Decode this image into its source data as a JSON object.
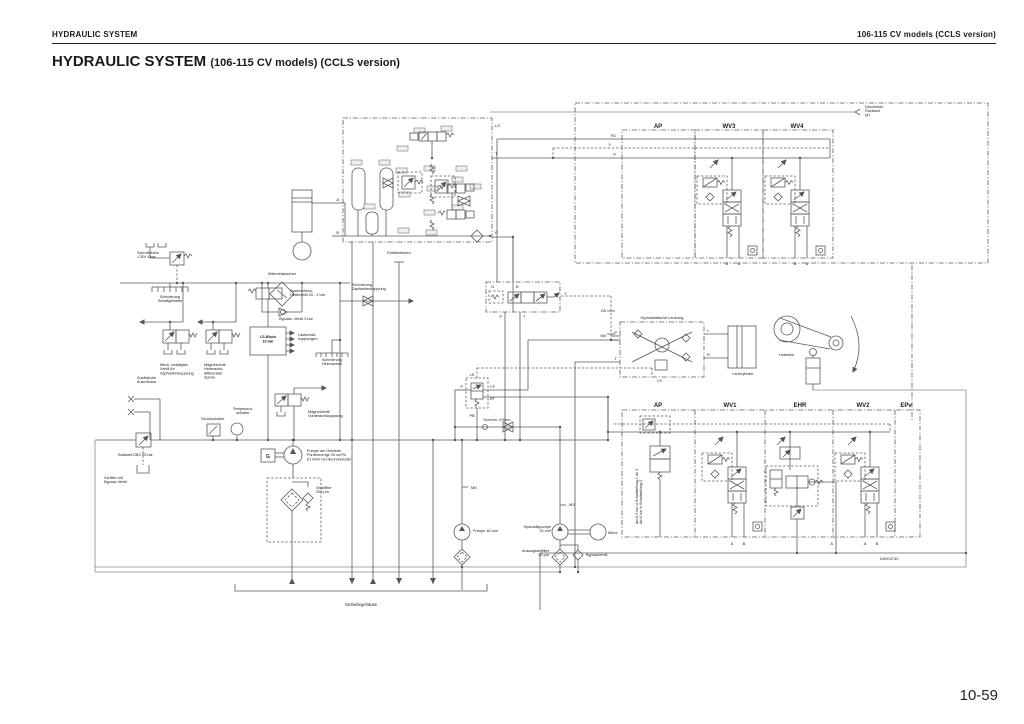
{
  "page": {
    "running_head_left": "HYDRAULIC SYSTEM",
    "running_head_right": "106-115 CV models (CCLS version)",
    "title": "HYDRAULIC SYSTEM",
    "title_suffix": "(106-115 CV models) (CCLS version)",
    "page_number": "10-59"
  },
  "diagram": {
    "labels": [
      {
        "n": "drucklose-ruecklauf",
        "t": [
          "Druckloser",
          "Rücklauf",
          "M7"
        ],
        "x": 865,
        "y": 108,
        "fs": 3.8,
        "lh": 4.2
      },
      {
        "n": "ap-top",
        "t": [
          "AP"
        ],
        "x": 658,
        "y": 128,
        "fs": 6,
        "b": 1,
        "a": "middle"
      },
      {
        "n": "wv3",
        "t": [
          "WV3"
        ],
        "x": 729,
        "y": 128,
        "fs": 6,
        "b": 1,
        "a": "middle"
      },
      {
        "n": "wv4",
        "t": [
          "WV4"
        ],
        "x": 797,
        "y": 128,
        "fs": 6,
        "b": 1,
        "a": "middle"
      },
      {
        "n": "r1-port",
        "t": [
          "R1"
        ],
        "x": 616,
        "y": 137,
        "fs": 4,
        "a": "end"
      },
      {
        "n": "y-port",
        "t": [
          "Y"
        ],
        "x": 611,
        "y": 146,
        "fs": 4,
        "a": "end"
      },
      {
        "n": "p-port-top",
        "t": [
          "P"
        ],
        "x": 616,
        "y": 156,
        "fs": 4,
        "a": "end"
      },
      {
        "n": "a-wv3",
        "t": [
          "A"
        ],
        "x": 727,
        "y": 265,
        "fs": 4,
        "a": "middle"
      },
      {
        "n": "b-wv3",
        "t": [
          "B"
        ],
        "x": 739,
        "y": 265,
        "fs": 4,
        "a": "middle"
      },
      {
        "n": "a-wv4",
        "t": [
          "A"
        ],
        "x": 795,
        "y": 265,
        "fs": 4,
        "a": "middle"
      },
      {
        "n": "b-wv4",
        "t": [
          "B"
        ],
        "x": 807,
        "y": 265,
        "fs": 4,
        "a": "middle"
      },
      {
        "n": "ls-valveblock",
        "t": [
          "LS"
        ],
        "x": 495,
        "y": 127,
        "fs": 4
      },
      {
        "n": "t-valveblock",
        "t": [
          "T"
        ],
        "x": 495,
        "y": 155,
        "fs": 4
      },
      {
        "n": "p-valveblock",
        "t": [
          "P"
        ],
        "x": 495,
        "y": 234,
        "fs": 4
      },
      {
        "n": "a-valveblock",
        "t": [
          "A"
        ],
        "x": 339,
        "y": 201,
        "fs": 4,
        "a": "end"
      },
      {
        "n": "b-valveblock",
        "t": [
          "B"
        ],
        "x": 339,
        "y": 234,
        "fs": 4,
        "a": "end"
      },
      {
        "n": "schmierkreis-cbv",
        "t": [
          "Schmierkreis",
          "-CBV 4 bar"
        ],
        "x": 137,
        "y": 254,
        "fs": 3.8,
        "lh": 4.2
      },
      {
        "n": "waermetauscher",
        "t": [
          "Wärmetauscher"
        ],
        "x": 282,
        "y": 275,
        "fs": 4,
        "a": "middle"
      },
      {
        "n": "schmierung-schaltgetriebe",
        "t": [
          "Schmierung",
          "Schaltgetriebe"
        ],
        "x": 170,
        "y": 298,
        "fs": 3.8,
        "a": "middle",
        "lh": 4.2
      },
      {
        "n": "bypass-ventil-3bar",
        "t": [
          "Bypass- Ventil 3 bar"
        ],
        "x": 296,
        "y": 320,
        "fs": 3.8,
        "a": "middle"
      },
      {
        "n": "systemdruck-halteventil",
        "t": [
          "Systemdruck-",
          "Halteventil 20 - 2 bar"
        ],
        "x": 290,
        "y": 292,
        "fs": 3.8,
        "lh": 4.2
      },
      {
        "n": "ls-block-text",
        "t": [
          "LS-Block",
          "10 bar"
        ],
        "x": 268,
        "y": 338,
        "fs": 3.8,
        "b": 1,
        "a": "middle",
        "lh": 4.4
      },
      {
        "n": "lastschalt-kupplungen",
        "t": [
          "Lastschalt-",
          "kupplungen"
        ],
        "x": 298,
        "y": 336,
        "fs": 3.8,
        "lh": 4.2
      },
      {
        "n": "mech-ventil-zapfwelle",
        "t": [
          "Mech. betätigtes",
          "Ventil für",
          "Zapfwellenkupplung"
        ],
        "x": 160,
        "y": 366,
        "fs": 3.8,
        "lh": 4.2
      },
      {
        "n": "magnetventil-hinterachs",
        "t": [
          "Magnetventil",
          "Hinterachs-",
          "differential-",
          "Sperre"
        ],
        "x": 204,
        "y": 366,
        "fs": 3.8,
        "lh": 4.2
      },
      {
        "n": "schmierung-hinterachse",
        "t": [
          "Schmierung",
          "Hinterachse"
        ],
        "x": 332,
        "y": 361,
        "fs": 3.8,
        "a": "middle",
        "lh": 4.2
      },
      {
        "n": "magnetventil-vorderachs",
        "t": [
          "Magnetventil",
          "Vorderachskupplung"
        ],
        "x": 308,
        "y": 413,
        "fs": 3.8,
        "lh": 4.2
      },
      {
        "n": "zusaetzliche-anschluesse",
        "t": [
          "Zusätzliche",
          "Anschlüsse"
        ],
        "x": 137,
        "y": 379,
        "fs": 3.8,
        "lh": 4.2
      },
      {
        "n": "druckschalter",
        "t": [
          "Druckschalter"
        ],
        "x": 213,
        "y": 420,
        "fs": 3.8,
        "a": "middle"
      },
      {
        "n": "temperatur-schalter",
        "t": [
          "Temperatur-",
          "schalter"
        ],
        "x": 243,
        "y": 410,
        "fs": 3.8,
        "a": "middle",
        "lh": 4.2
      },
      {
        "n": "kaltstart-dbv",
        "t": [
          "Kaltstart-DBV 25 bar"
        ],
        "x": 118,
        "y": 456,
        "fs": 3.8
      },
      {
        "n": "vorfilter",
        "t": [
          "Vorfilter mit",
          "Bypass-Ventil"
        ],
        "x": 104,
        "y": 479,
        "fs": 3.8,
        "lh": 4.2
      },
      {
        "n": "g-box-label",
        "t": [
          "G"
        ],
        "x": 268,
        "y": 458,
        "fs": 5,
        "b": 1,
        "a": "middle"
      },
      {
        "n": "pumpe-am-getriebe",
        "t": [
          "Pumpe am Getriebe",
          "Fördermenge 25 cm³/U",
          "61 l/min bei Nenndrehzahl"
        ],
        "x": 307,
        "y": 452,
        "fs": 3.8,
        "lh": 4.2
      },
      {
        "n": "grobfilter",
        "t": [
          "Grobfilter",
          "200 μm"
        ],
        "x": 316,
        "y": 489,
        "fs": 3.8,
        "lh": 4.2
      },
      {
        "n": "einfuellstutzen",
        "t": [
          "Einfüllstutzen"
        ],
        "x": 399,
        "y": 254,
        "fs": 4,
        "a": "middle"
      },
      {
        "n": "schmierung-zapfwellenkupplung",
        "t": [
          "Schmierung",
          "Zapfwellenkupplung"
        ],
        "x": 352,
        "y": 286,
        "fs": 3.8,
        "lh": 4.2
      },
      {
        "n": "durchmesser",
        "t": [
          "Durchm. 0,5mm"
        ],
        "x": 497,
        "y": 421,
        "fs": 3.8,
        "a": "middle"
      },
      {
        "n": "getriebegehaeuse",
        "t": [
          "Getriebegehäuse"
        ],
        "x": 361,
        "y": 606,
        "fs": 4.2,
        "a": "middle"
      },
      {
        "n": "pumpe-16ccm",
        "t": [
          "Pumpe 16 ccm"
        ],
        "x": 473,
        "y": 532,
        "fs": 3.8
      },
      {
        "n": "m6",
        "t": [
          "M6"
        ],
        "x": 471,
        "y": 489,
        "fs": 4
      },
      {
        "n": "m3",
        "t": [
          "M3"
        ],
        "x": 569,
        "y": 506,
        "fs": 4
      },
      {
        "n": "hydraulikpumpe",
        "t": [
          "Hydraulikpumpe",
          "32 cm³"
        ],
        "x": 551,
        "y": 528,
        "fs": 3.8,
        "a": "end",
        "lh": 4.2
      },
      {
        "n": "motor",
        "t": [
          "Motor"
        ],
        "x": 608,
        "y": 534,
        "fs": 3.8
      },
      {
        "n": "ansaugsiebfilter",
        "t": [
          "Ansaugsiebfilter",
          "25 μm"
        ],
        "x": 549,
        "y": 552,
        "fs": 3.8,
        "a": "end",
        "lh": 4.2
      },
      {
        "n": "bypassventil",
        "t": [
          "Bypassventil"
        ],
        "x": 586,
        "y": 556,
        "fs": 3.8
      },
      {
        "n": "d5",
        "t": [
          "D5"
        ],
        "x": 606,
        "y": 312,
        "fs": 4,
        "a": "end"
      },
      {
        "n": "m4",
        "t": [
          "M4"
        ],
        "x": 606,
        "y": 337,
        "fs": 4,
        "a": "end"
      },
      {
        "n": "hydrostatische-lenkung",
        "t": [
          "Hydrostatische Lenkung"
        ],
        "x": 662,
        "y": 319,
        "fs": 4,
        "a": "middle"
      },
      {
        "n": "p-lenkung",
        "t": [
          "P"
        ],
        "x": 617,
        "y": 334,
        "fs": 4,
        "a": "end"
      },
      {
        "n": "t-lenkung",
        "t": [
          "T"
        ],
        "x": 617,
        "y": 360,
        "fs": 4,
        "a": "end"
      },
      {
        "n": "l-lenkung",
        "t": [
          "L"
        ],
        "x": 707,
        "y": 332,
        "fs": 4
      },
      {
        "n": "r-lenkung",
        "t": [
          "R"
        ],
        "x": 707,
        "y": 356,
        "fs": 4
      },
      {
        "n": "ls-lenkung",
        "t": [
          "LS"
        ],
        "x": 657,
        "y": 382,
        "fs": 4
      },
      {
        "n": "lenkzylinder",
        "t": [
          "Lenkzylinder"
        ],
        "x": 743,
        "y": 375,
        "fs": 3.8,
        "a": "middle"
      },
      {
        "n": "hubwerk",
        "t": [
          "Hubwerk"
        ],
        "x": 779,
        "y": 356,
        "fs": 3.8
      },
      {
        "n": "ap-bottom",
        "t": [
          "AP"
        ],
        "x": 658,
        "y": 407,
        "fs": 6,
        "b": 1,
        "a": "middle"
      },
      {
        "n": "wv1",
        "t": [
          "WV1"
        ],
        "x": 730,
        "y": 407,
        "fs": 6,
        "b": 1,
        "a": "middle"
      },
      {
        "n": "ehr",
        "t": [
          "EHR"
        ],
        "x": 800,
        "y": 407,
        "fs": 6,
        "b": 1,
        "a": "middle"
      },
      {
        "n": "wv2",
        "t": [
          "WV2"
        ],
        "x": 863,
        "y": 407,
        "fs": 6,
        "b": 1,
        "a": "middle"
      },
      {
        "n": "epv",
        "t": [
          "EPv"
        ],
        "x": 906,
        "y": 407,
        "fs": 6,
        "b": 1,
        "a": "middle"
      },
      {
        "n": "delta-p-note",
        "t": [
          "Δp=0,4 bar in Schaltstellung 1 od. 2",
          "Δp=0 bar in Schaltstellung 0"
        ],
        "x": 638,
        "y": 524,
        "fs": 3.5,
        "r": -90,
        "lh": 4.2
      },
      {
        "n": "drawing-number",
        "t": [
          "D0004740"
        ],
        "x": 880,
        "y": 560,
        "fs": 4
      },
      {
        "n": "a-wv1",
        "t": [
          "A"
        ],
        "x": 732,
        "y": 545,
        "fs": 4,
        "a": "middle"
      },
      {
        "n": "b-wv1",
        "t": [
          "B"
        ],
        "x": 744,
        "y": 545,
        "fs": 4,
        "a": "middle"
      },
      {
        "n": "a-ehr",
        "t": [
          "A"
        ],
        "x": 833,
        "y": 545,
        "fs": 4,
        "a": "end"
      },
      {
        "n": "a-wv2",
        "t": [
          "A"
        ],
        "x": 865,
        "y": 545,
        "fs": 4,
        "a": "middle"
      },
      {
        "n": "b-wv2",
        "t": [
          "B"
        ],
        "x": 877,
        "y": 545,
        "fs": 4,
        "a": "middle"
      },
      {
        "n": "ls-priority",
        "t": [
          "LS"
        ],
        "x": 472,
        "y": 376,
        "fs": 3.8,
        "a": "middle"
      },
      {
        "n": "p-priority",
        "t": [
          "P"
        ],
        "x": 463,
        "y": 388,
        "fs": 3.8,
        "a": "end"
      },
      {
        "n": "cf-priority",
        "t": [
          "CF"
        ],
        "x": 490,
        "y": 388,
        "fs": 3.8
      },
      {
        "n": "ef-priority",
        "t": [
          "EF"
        ],
        "x": 490,
        "y": 400,
        "fs": 3.8
      },
      {
        "n": "pb-priority",
        "t": [
          "PB"
        ],
        "x": 472,
        "y": 417,
        "fs": 3.8,
        "a": "middle"
      },
      {
        "n": "n-mittelblock",
        "t": [
          "N"
        ],
        "x": 494,
        "y": 288,
        "fs": 3.8,
        "a": "end"
      },
      {
        "n": "b-mittelblock",
        "t": [
          "B"
        ],
        "x": 516,
        "y": 288,
        "fs": 3.8
      },
      {
        "n": "p-mittelblock",
        "t": [
          "P"
        ],
        "x": 502,
        "y": 318,
        "fs": 3.8,
        "a": "end"
      },
      {
        "n": "t-mittelblock",
        "t": [
          "T"
        ],
        "x": 523,
        "y": 318,
        "fs": 3.8
      },
      {
        "n": "y-mittelblock",
        "t": [
          "Y"
        ],
        "x": 564,
        "y": 295,
        "fs": 3.8
      }
    ]
  }
}
